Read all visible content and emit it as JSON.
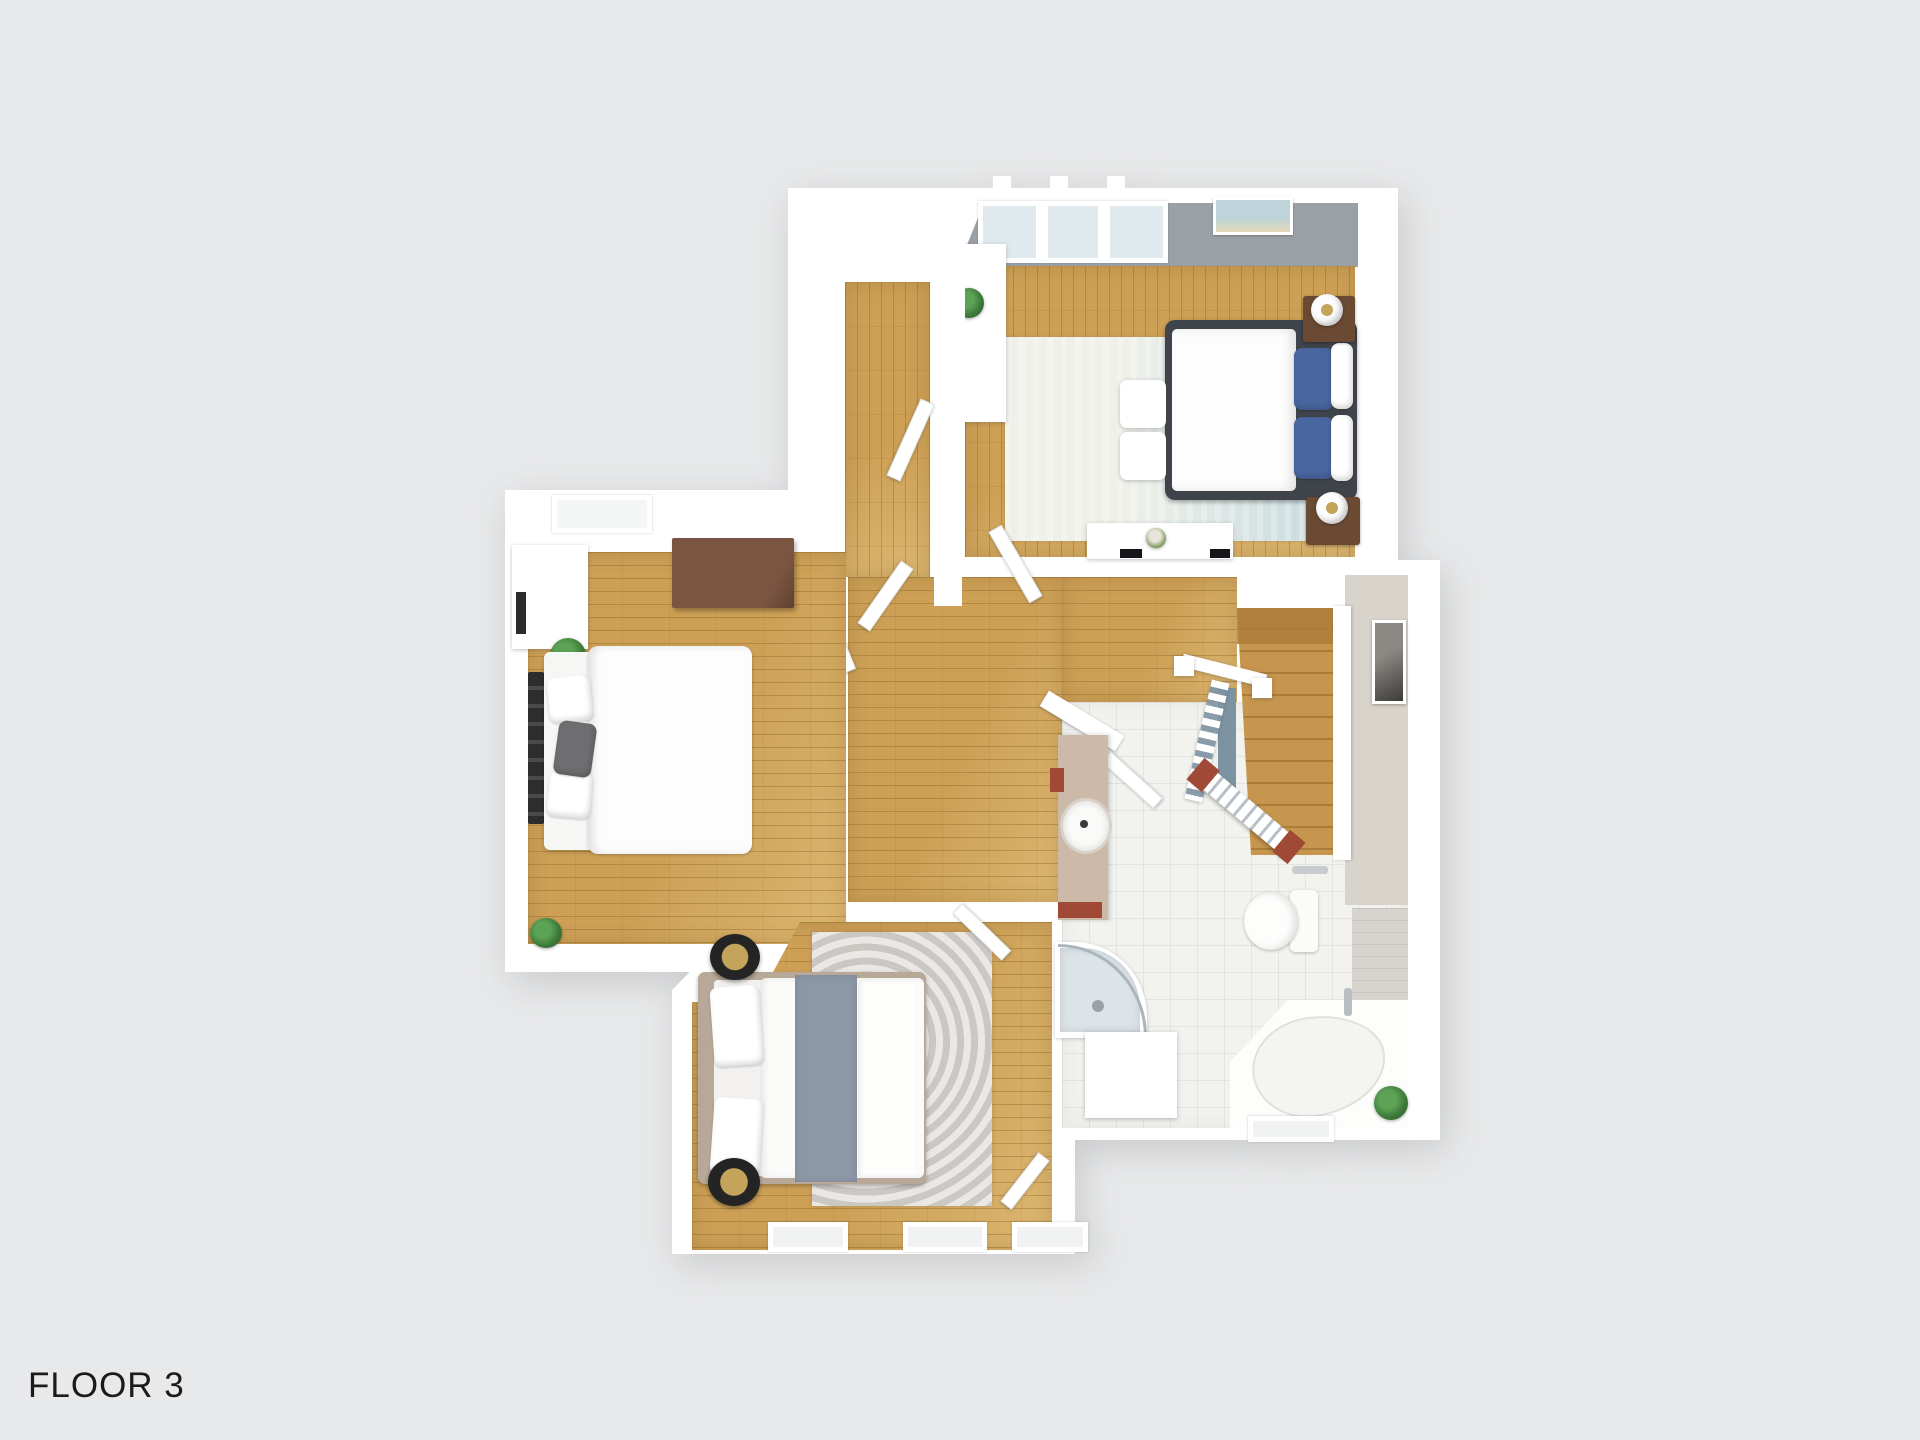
{
  "floor_label": "FLOOR 3",
  "view": "3d-top-down-floor-plan",
  "palette": {
    "background": "#e8e9ea",
    "wall": "#ffffff",
    "gray_wall": "#9aa1a6",
    "wood": "#cda056",
    "wood_light": "#dcb670",
    "wood_line": "rgba(118,79,24,0.30)",
    "tile": "#f2f2ef",
    "tile_line": "rgba(0,0,0,0.06)",
    "landing": "#d8d3cb",
    "stairs": "#c6954e",
    "stairs_dark": "#ab7c3a",
    "slate": "#7e93a2",
    "terracotta": "#a04936",
    "rug_master_a": "#eef0e9",
    "rug_master_b": "#c2d8dd",
    "rug_gray": "#d3d0cb",
    "bed_dark": "#3f444a",
    "pillow_blue": "#4a66a0",
    "nightstand_brown": "#6b4a34",
    "dresser_brown": "#7a5541",
    "bed_beige": "#b7a897",
    "blanket_gray": "#8d98a6",
    "gold": "#c4a35a",
    "plant": "#3e7a3a",
    "glass": "#dfe9ee",
    "bath_wood": "#d7d4d0",
    "label": "#1b1b19"
  },
  "rooms": {
    "master_bedroom": [
      "double-bed",
      "blue-pillows",
      "nightstand-left",
      "nightstand-right",
      "table-lamps",
      "ottomans",
      "rug",
      "dresser",
      "wardrobe",
      "plant",
      "windows",
      "wall-art"
    ],
    "left_bedroom": [
      "double-bed",
      "black-headboard",
      "gray-pillow",
      "wall-shelf",
      "brown-dresser",
      "plants",
      "skylight"
    ],
    "bottom_bedroom": [
      "double-bed",
      "gray-blanket",
      "round-side-tables",
      "black-lamps",
      "patterned-rug",
      "windows"
    ],
    "bathroom": [
      "vanity-sink",
      "corner-shower",
      "toilet",
      "corner-bathtub",
      "plant",
      "window",
      "tile-floor"
    ],
    "circulation": [
      "hallway",
      "walk-in-corridor",
      "staircase",
      "stair-railings",
      "doors"
    ]
  }
}
